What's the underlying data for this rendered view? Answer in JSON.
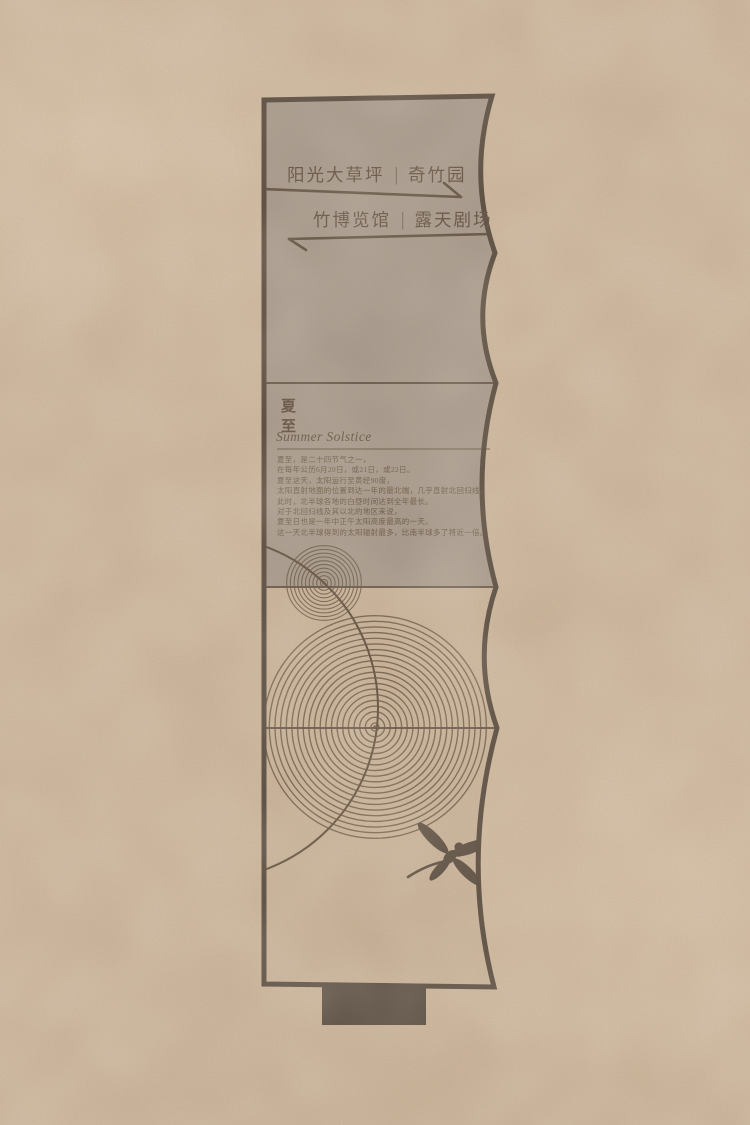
{
  "directory": {
    "row1": {
      "label_a": "阳光大草坪",
      "separator": "|",
      "label_b": "奇竹园",
      "direction": "right"
    },
    "row2": {
      "label_a": "竹博览馆",
      "separator": "|",
      "label_b": "露天剧场",
      "direction": "left"
    }
  },
  "season": {
    "title_cn": "夏至",
    "title_en": "Summer Solstice",
    "description_lines": [
      "夏至，是二十四节气之一，",
      "在每年公历6月20日，或21日，或22日。",
      "夏至这天，太阳运行至黄经90度，",
      "太阳直射地面的位置到达一年的最北端，几乎直射北回归线，",
      "此时，北半球各地的白昼时间达到全年最长。",
      "对于北回归线及其以北的地区来说，",
      "夏至日也是一年中正午太阳高度最高的一天。",
      "这一天北半球得到的太阳辐射最多，比南半球多了将近一倍。"
    ]
  },
  "icons": {
    "arrow_right": "right-pointing wayfinding arrow",
    "arrow_left": "left-pointing wayfinding arrow",
    "dragonfly": "dragonfly silhouette",
    "ripples_small": "small concentric ripple rings",
    "ripples_large": "large concentric ripple rings",
    "orbit_circle": "thin sweeping circle"
  },
  "colors": {
    "background": "#c9b095",
    "panel_dark": "#9c8e81",
    "panel_light": "#c5ac91",
    "outline": "#3b2e23",
    "ink": "#4b382a",
    "ripple_line": "#503d29",
    "base": "#3b2f25"
  },
  "graphics": {
    "ripples": [
      {
        "cx": 324,
        "cy": 583,
        "count": 10,
        "r0": 3.6,
        "step": 3.75,
        "width": 1.1
      },
      {
        "cx": 375,
        "cy": 727,
        "count": 20,
        "r0": 4.0,
        "step": 5.65,
        "width": 1.35
      }
    ],
    "orbit": {
      "cx": 206,
      "cy": 708,
      "r": 172
    }
  }
}
